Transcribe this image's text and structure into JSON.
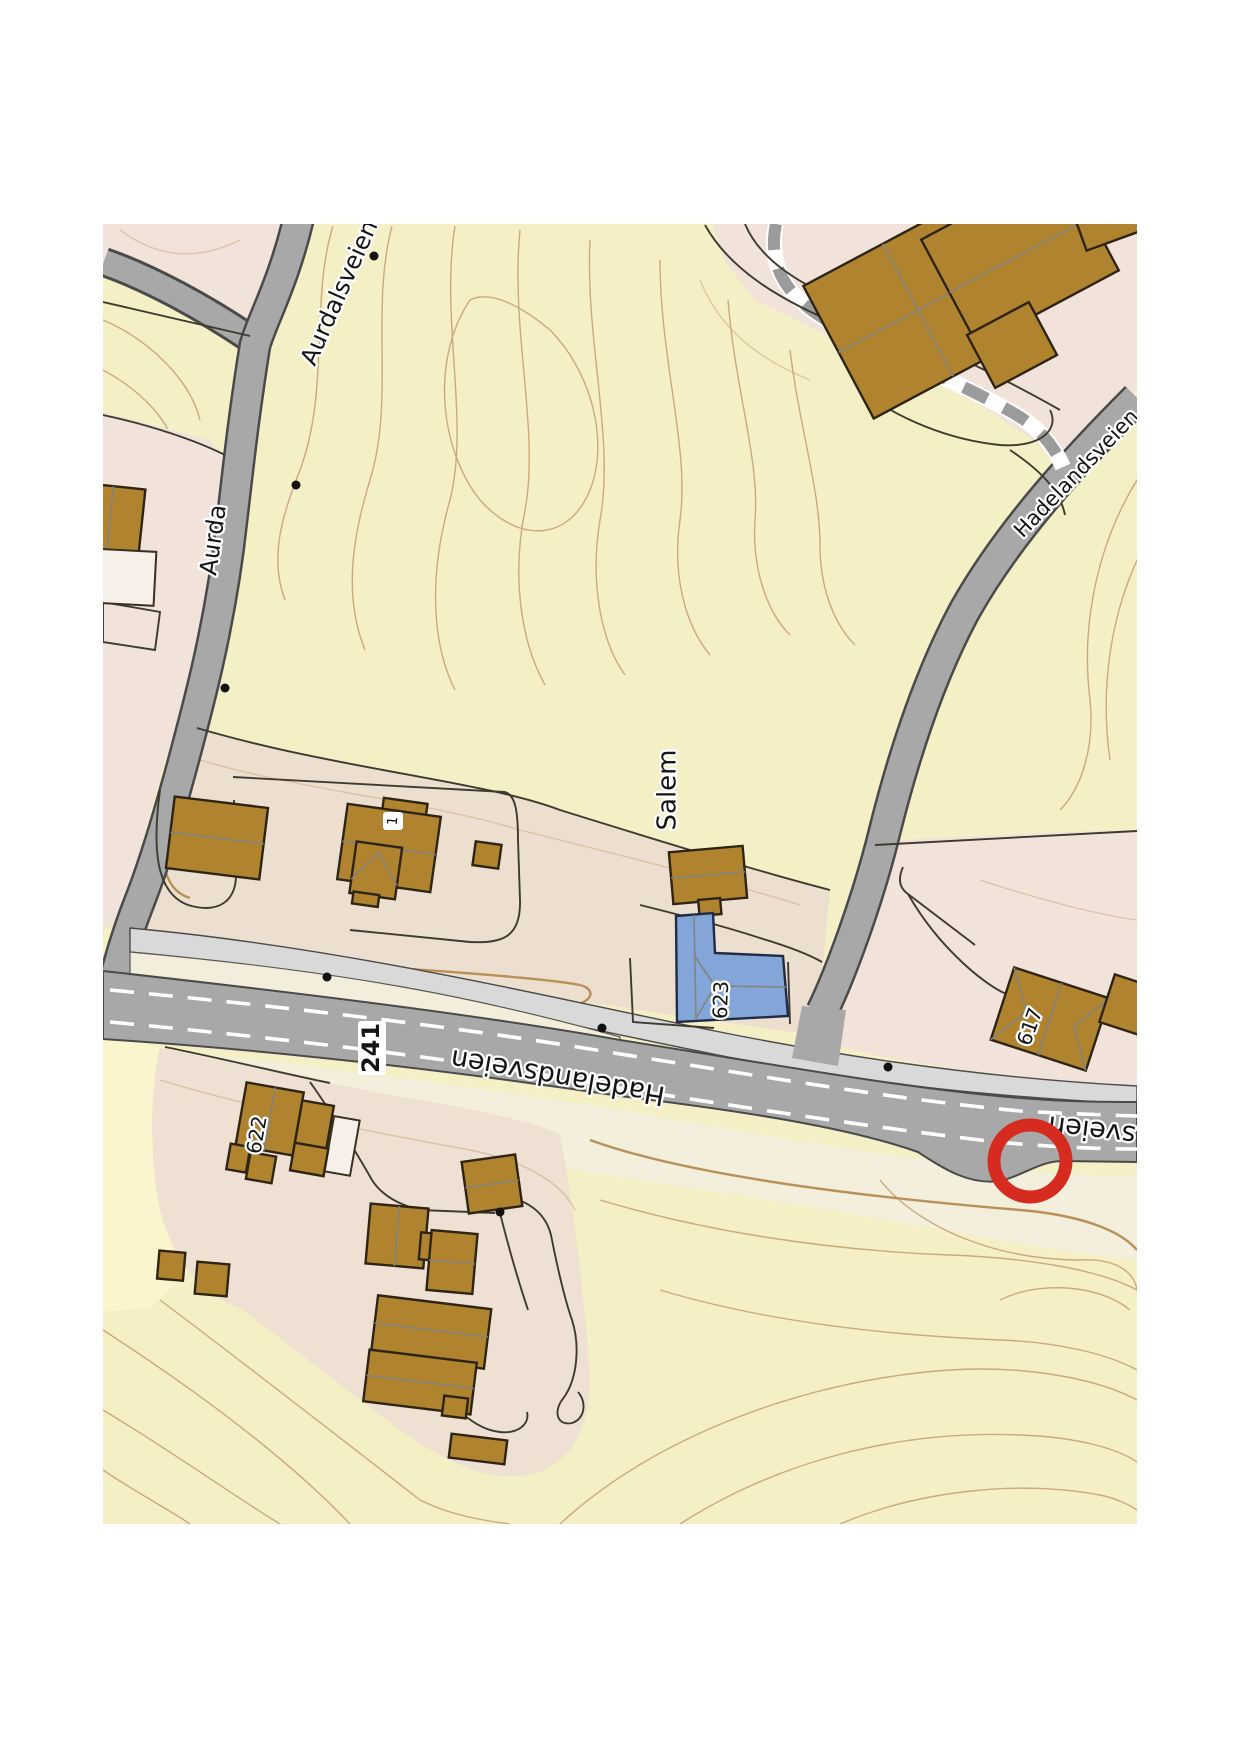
{
  "map": {
    "description": "Norwegian topographic map extract with red highlight circle",
    "roads": {
      "aurdalsveien_top_label": "Aurdalsveien",
      "aurdalsveien_partial_label": "Aurda",
      "hadelandsveien_northeast_label": "Hadelandsveien",
      "hadelandsveien_main_label": "Hadelandsveien",
      "hadelandsveien_right_partial_label": "sveien",
      "route_badge": "241"
    },
    "places": {
      "salem": "Salem"
    },
    "house_numbers": {
      "n1": "1",
      "n617": "617",
      "n622": "622",
      "n623": "623"
    },
    "marker": {
      "shape": "circle",
      "color": "#d62b1f"
    },
    "colors": {
      "terrain_yellow": "#f4efc4",
      "terrain_yellow_light": "#faf5cd",
      "parcel_pink": "#f1e3da",
      "parcel_beige": "#ecdfd0",
      "road_gray": "#a8a8a8",
      "sidewalk_gray": "#d9d9d9",
      "building_brown": "#b0842e",
      "building_blue": "#84a5d8",
      "contour_tan": "#c9aa7e",
      "marker_red": "#d62b1f"
    }
  }
}
